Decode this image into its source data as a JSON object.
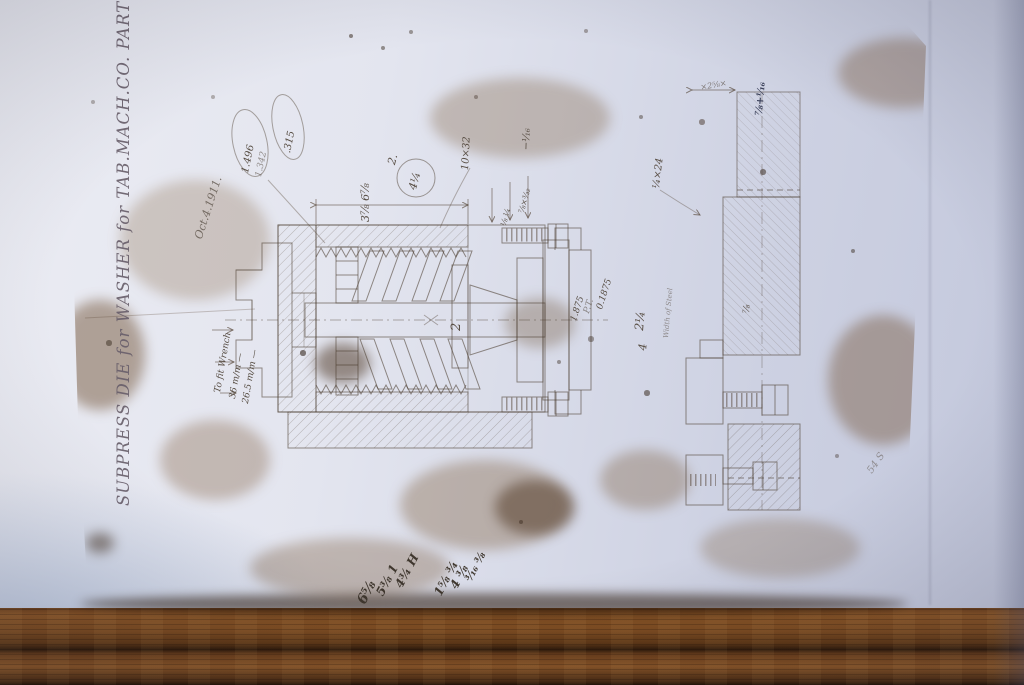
{
  "palette": {
    "wall": "#dfe2ee",
    "wall_shadow": "#c2c7dc",
    "paper": "#ba9d78",
    "paper_light": "#d8cdb4",
    "wood": "#8a5526",
    "wood_dark": "#2f1a09",
    "pencil": "#584e44",
    "ink": "#3b415a"
  },
  "paper": {
    "title": "SUBPRESS DIE for WASHER for TAB.MACH.CO. PART №76.",
    "date_note": "Oct.4.1911.",
    "stamps": {
      "oval1_line1": "1.496",
      "oval1_line2": "1.342",
      "oval2": ".315"
    },
    "notes": {
      "beside_circle": "2.",
      "circled": "4¼",
      "stack": "3⅞  6⅞",
      "thread": "10×32",
      "minus_sixteenth": "−¹⁄₁₆",
      "small_dims": "⅞×³⁄₃₂",
      "small_dims_2": "⅛  ¼",
      "decimal_a": "1.875",
      "decimal_b": "P.T.",
      "decimal_c": "0.1875",
      "between_a": "2¼",
      "between_b": "4",
      "width_of_steel": "Width of Steel",
      "wrench": "To fit Wrench",
      "wrench_a": "36 m/m —",
      "wrench_b": "26.5 m/m —",
      "bolt": "¼×24",
      "top_right": "×2⅝×",
      "top_right_ink": "⅞+¹⁄₁₆",
      "flange": "⅞",
      "part_label": "2"
    },
    "scribbles": {
      "a1": "6⅝",
      "a2": "5⅜ 1",
      "a3": "4¾ H",
      "b1": "1⅝ ¾",
      "b2": "4 ⅜",
      "b3": "³⁄₁₆ ⅜",
      "c1": "54 S"
    }
  }
}
